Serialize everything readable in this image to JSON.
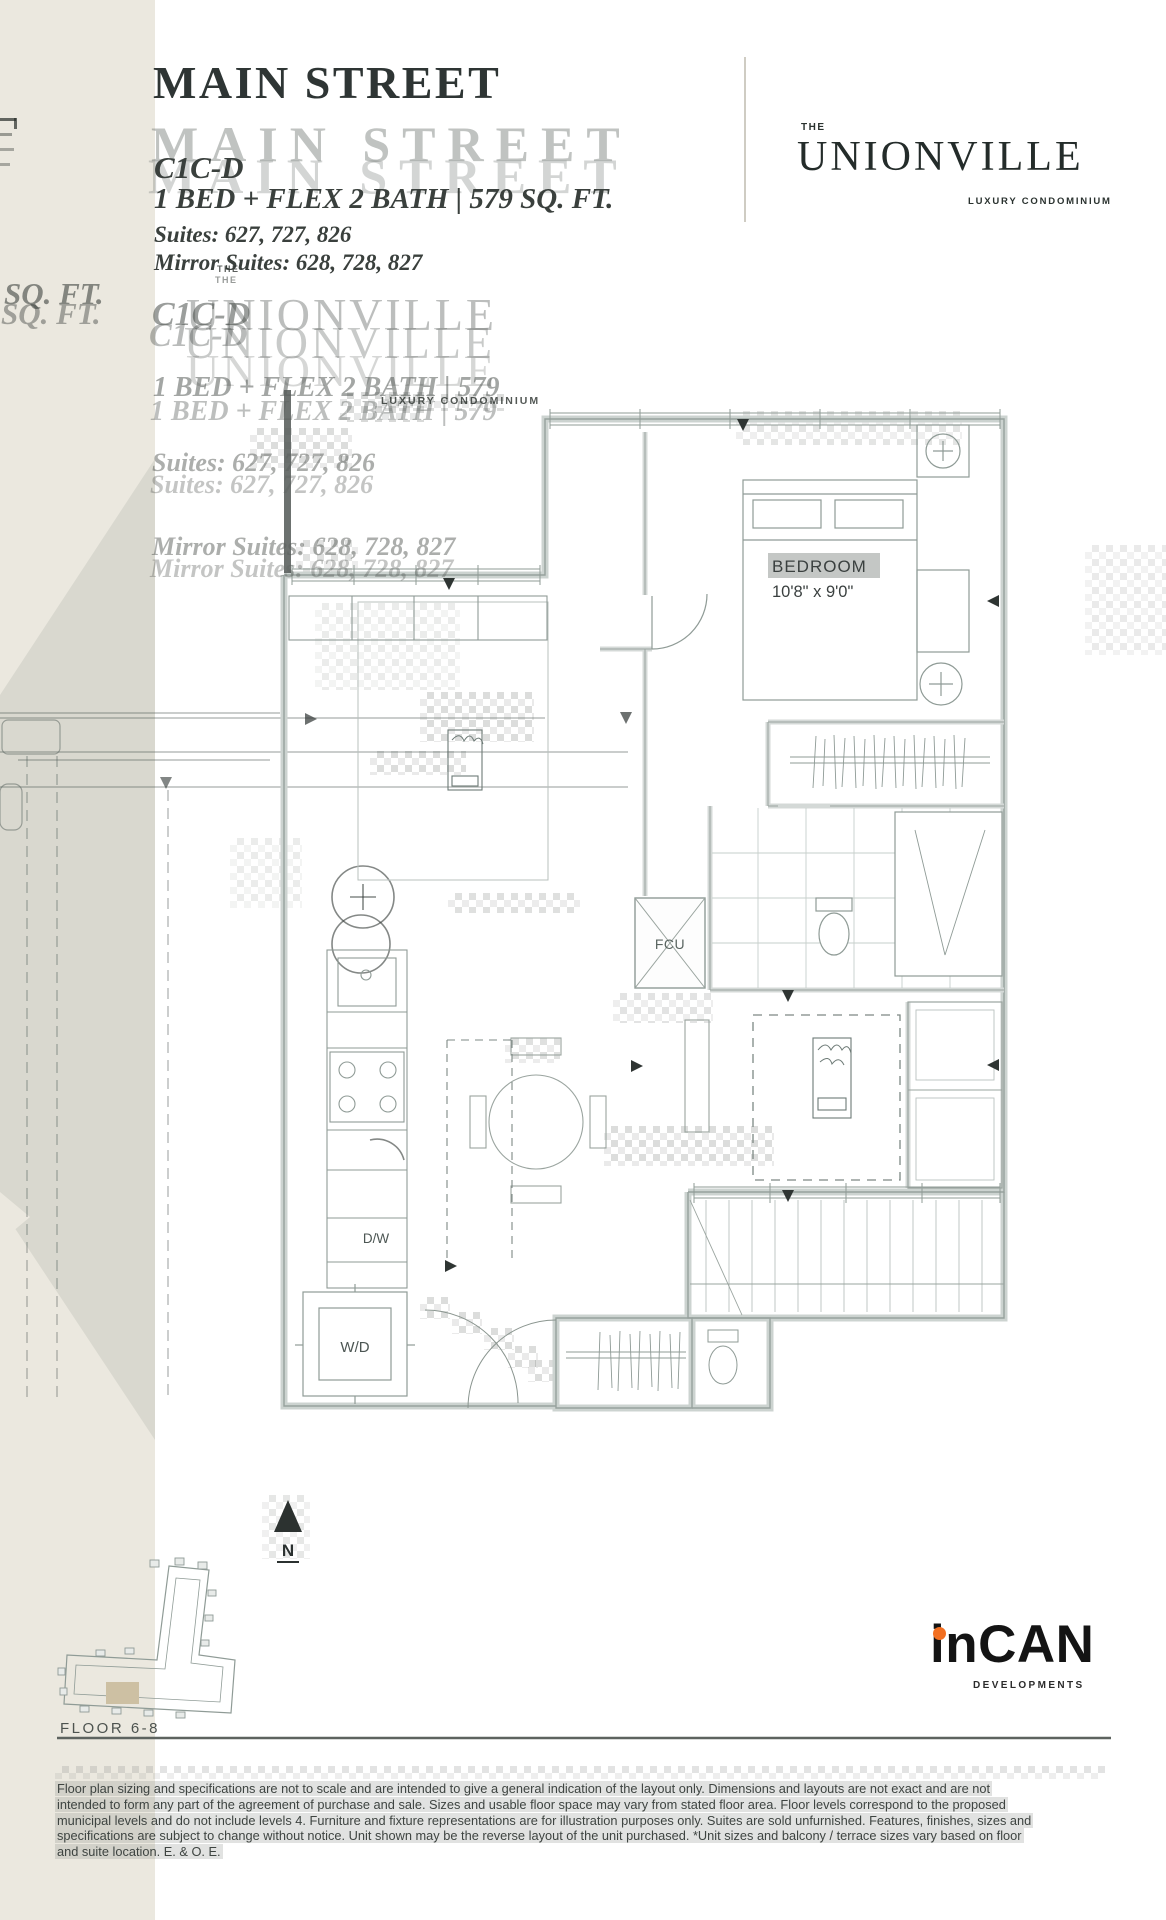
{
  "page": {
    "background": "#ffffff"
  },
  "sidebar": {
    "base_color": "#ebe8df",
    "chevron_color": "#d9d8cf",
    "ghost_sqft": "SQ. FT."
  },
  "header": {
    "title": "MAIN STREET",
    "plan_code": "C1C-D",
    "specs": "1 BED + FLEX 2 BATH | 579 SQ. FT.",
    "suites": "Suites: 627, 727, 826",
    "mirror_suites": "Mirror Suites: 628, 728, 827",
    "ghost_specs": "1 BED + FLEX 2 BATH | 579"
  },
  "brand": {
    "the": "THE",
    "wordmark": "UNIONVILLE",
    "tagline": "LUXURY CONDOMINIUM"
  },
  "plan": {
    "bedroom_label": "BEDROOM",
    "bedroom_dims": "10'8\" x 9'0\"",
    "fcu_label": "FCU",
    "dw_label": "D/W",
    "wd_label": "W/D"
  },
  "compass": {
    "north_label": "N"
  },
  "keyplan": {
    "floor_label": "FLOOR 6-8",
    "highlight_color": "#cdc0a3"
  },
  "developer": {
    "name": "inCAN",
    "subtitle": "DEVELOPMENTS",
    "dot_color": "#f26f21"
  },
  "disclaimer": {
    "lines": [
      "Floor plan sizing and specifications are not to scale and are intended to give a general indication of the layout only. Dimensions and layouts are not exact and are not",
      "intended to form any part of the agreement of purchase and sale. Sizes and usable floor space may vary from stated floor area. Floor levels correspond to the proposed",
      "municipal levels and do not include levels 4. Furniture and fixture representations are for illustration purposes only. Suites are sold unfurnished. Features, finishes, sizes and",
      "specifications are subject to change without notice. Unit shown may be the reverse layout of the unit purchased. *Unit sizes and balcony / terrace sizes vary based on floor",
      "and suite location. E. & O. E."
    ]
  },
  "colors": {
    "text_dark": "#2e3534",
    "ghost_gray": "#8e938f",
    "plan_line": "#95a09b",
    "wall_fill": "#ccd3d0",
    "accent_orange": "#f26f21"
  }
}
